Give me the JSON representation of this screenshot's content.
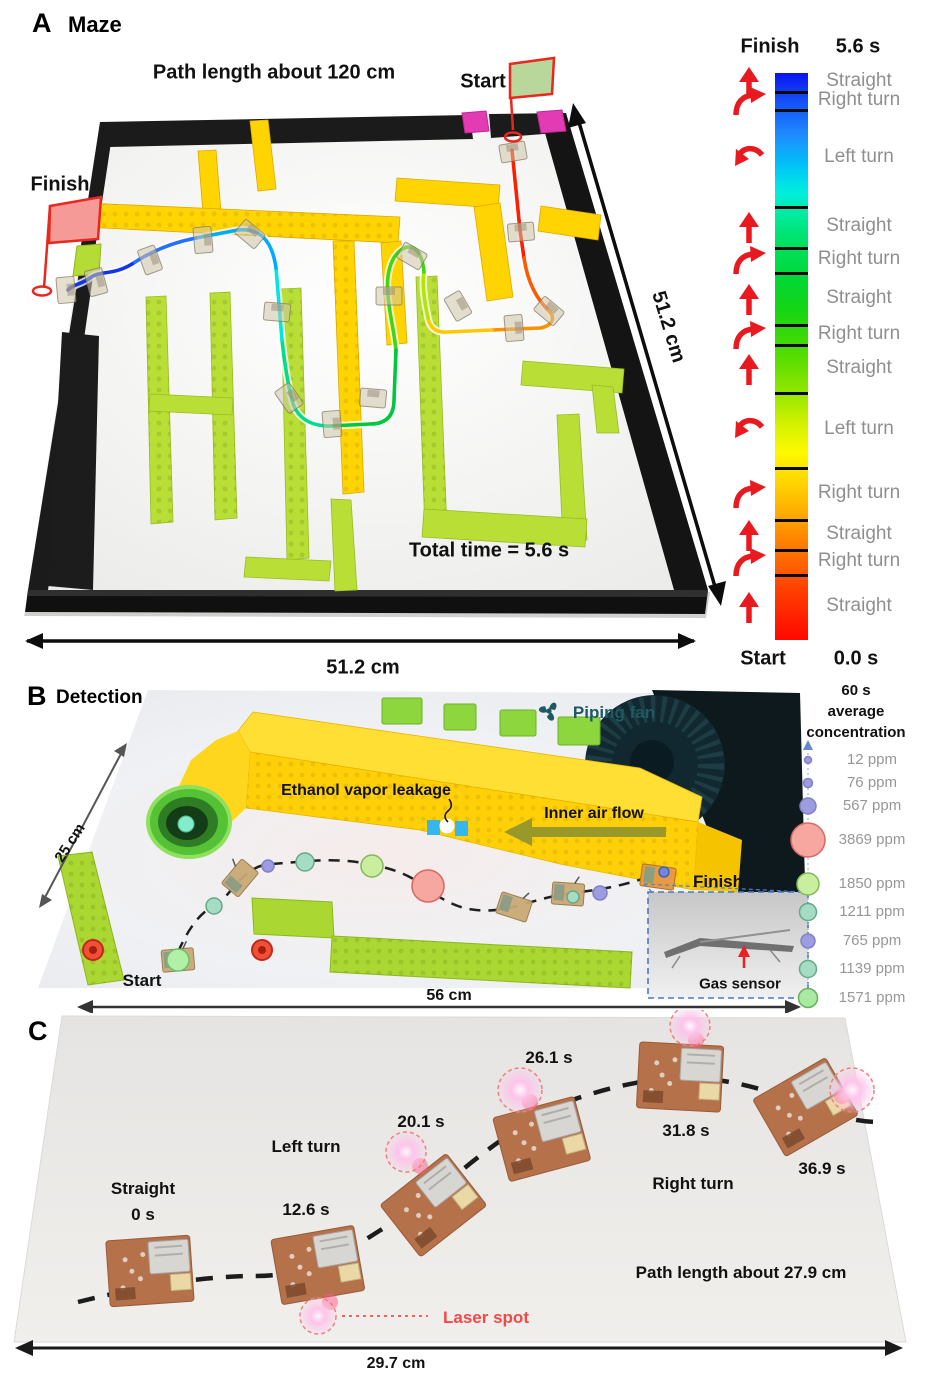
{
  "figure": {
    "panels": {
      "a": {
        "tag": "A",
        "title": "Maze",
        "annotations": [
          {
            "id": "path-length",
            "text": "Path length about 120 cm",
            "x": 274,
            "y": 73,
            "size": 20
          },
          {
            "id": "start",
            "text": "Start",
            "x": 483,
            "y": 82,
            "size": 20
          },
          {
            "id": "finish",
            "text": "Finish",
            "x": 60,
            "y": 185,
            "size": 20
          },
          {
            "id": "total-time",
            "text": "Total time = 5.6 s",
            "x": 489,
            "y": 551,
            "size": 20
          },
          {
            "id": "width-dim",
            "text": "51.2 cm",
            "x": 363,
            "y": 668,
            "size": 20
          },
          {
            "id": "height-dim",
            "text": "51.2 cm",
            "x": 668,
            "y": 327,
            "size": 20,
            "rot": 73
          }
        ],
        "legend": {
          "finish_label": "Finish",
          "finish_time": "5.6 s",
          "start_label": "Start",
          "start_time": "0.0 s",
          "bar_top": 73,
          "bar_height": 567,
          "bar_ticks": [
            92,
            110,
            207,
            248,
            273,
            325,
            345,
            393,
            468,
            520,
            550,
            575
          ],
          "entries": [
            {
              "label": "Straight",
              "arrow": "straight",
              "y": 82
            },
            {
              "label": "Right turn",
              "arrow": "right",
              "y": 101
            },
            {
              "label": "Left turn",
              "arrow": "left",
              "y": 158
            },
            {
              "label": "Straight",
              "arrow": "straight",
              "y": 227
            },
            {
              "label": "Right turn",
              "arrow": "right",
              "y": 260
            },
            {
              "label": "Straight",
              "arrow": "straight",
              "y": 299
            },
            {
              "label": "Right turn",
              "arrow": "right",
              "y": 335
            },
            {
              "label": "Straight",
              "arrow": "straight",
              "y": 369
            },
            {
              "label": "Left turn",
              "arrow": "left",
              "y": 430
            },
            {
              "label": "Right turn",
              "arrow": "right",
              "y": 494
            },
            {
              "label": "Straight",
              "arrow": "straight",
              "y": 535
            },
            {
              "label": "Right turn",
              "arrow": "right",
              "y": 562
            },
            {
              "label": "Straight",
              "arrow": "straight",
              "y": 607
            }
          ]
        }
      },
      "b": {
        "tag": "B",
        "title": "Detection",
        "annotations": [
          {
            "id": "piping-fan",
            "text": "Piping fan",
            "x": 614,
            "y": 713,
            "size": 17,
            "color": "#1d5a64"
          },
          {
            "id": "ethanol-leak",
            "text": "Ethanol vapor leakage",
            "x": 366,
            "y": 791,
            "size": 16
          },
          {
            "id": "air-flow",
            "text": "Inner air flow",
            "x": 594,
            "y": 814,
            "size": 16
          },
          {
            "id": "start",
            "text": "Start",
            "x": 142,
            "y": 981,
            "size": 17
          },
          {
            "id": "finish",
            "text": "Finish",
            "x": 718,
            "y": 882,
            "size": 17
          },
          {
            "id": "gas-sensor",
            "text": "Gas sensor",
            "x": 740,
            "y": 984,
            "size": 15
          },
          {
            "id": "height-dim",
            "text": "25 cm",
            "x": 70,
            "y": 843,
            "size": 15,
            "rot": -57
          },
          {
            "id": "width-dim",
            "text": "56 cm",
            "x": 449,
            "y": 996,
            "size": 16
          }
        ],
        "legend": {
          "title_lines": [
            "60 s",
            "average",
            "concentration"
          ],
          "title_y": [
            691,
            712,
            733
          ],
          "entries": [
            {
              "value": "12 ppm",
              "y": 760,
              "r": 3.5,
              "fill": "#9d9ce0",
              "stroke": "#8080c8"
            },
            {
              "value": "76 ppm",
              "y": 783,
              "r": 4.5,
              "fill": "#9d9ce0",
              "stroke": "#8080c8"
            },
            {
              "value": "567 ppm",
              "y": 806,
              "r": 8,
              "fill": "#9d9ce0",
              "stroke": "#8080c8"
            },
            {
              "value": "3869 ppm",
              "y": 840,
              "r": 17,
              "fill": "#f5a7a0",
              "stroke": "#d86860"
            },
            {
              "value": "1850 ppm",
              "y": 884,
              "r": 11,
              "fill": "#c9ef9e",
              "stroke": "#84b858"
            },
            {
              "value": "1211 ppm",
              "y": 912,
              "r": 8.5,
              "fill": "#a5dcc4",
              "stroke": "#68a888"
            },
            {
              "value": "765 ppm",
              "y": 941,
              "r": 7,
              "fill": "#9d9ce0",
              "stroke": "#8080c8"
            },
            {
              "value": "1139 ppm",
              "y": 969,
              "r": 8.5,
              "fill": "#a5dcc4",
              "stroke": "#68a888"
            },
            {
              "value": "1571 ppm",
              "y": 998,
              "r": 9.5,
              "fill": "#a9e9a2",
              "stroke": "#66b060"
            }
          ]
        }
      },
      "c": {
        "tag": "C",
        "annotations": [
          {
            "id": "maneuver-straight",
            "text": "Straight",
            "x": 143,
            "y": 1189,
            "size": 17
          },
          {
            "id": "time-0s",
            "text": "0 s",
            "x": 143,
            "y": 1215,
            "size": 17
          },
          {
            "id": "maneuver-left-turn",
            "text": "Left turn",
            "x": 306,
            "y": 1147,
            "size": 17
          },
          {
            "id": "time-12-6s",
            "text": "12.6 s",
            "x": 306,
            "y": 1210,
            "size": 17
          },
          {
            "id": "time-20-1s",
            "text": "20.1 s",
            "x": 421,
            "y": 1122,
            "size": 17
          },
          {
            "id": "time-26-1s",
            "text": "26.1 s",
            "x": 549,
            "y": 1058,
            "size": 17
          },
          {
            "id": "time-31-8s",
            "text": "31.8 s",
            "x": 686,
            "y": 1131,
            "size": 17
          },
          {
            "id": "maneuver-right-turn",
            "text": "Right turn",
            "x": 693,
            "y": 1184,
            "size": 17
          },
          {
            "id": "time-36-9s",
            "text": "36.9 s",
            "x": 822,
            "y": 1169,
            "size": 17
          },
          {
            "id": "path-length",
            "text": "Path length about 27.9 cm",
            "x": 741,
            "y": 1273,
            "size": 17
          },
          {
            "id": "laser-spot",
            "text": "Laser spot",
            "x": 486,
            "y": 1318,
            "size": 17,
            "color": "#f24848"
          },
          {
            "id": "width-dim",
            "text": "29.7 cm",
            "x": 396,
            "y": 1364,
            "size": 16
          }
        ]
      }
    }
  }
}
